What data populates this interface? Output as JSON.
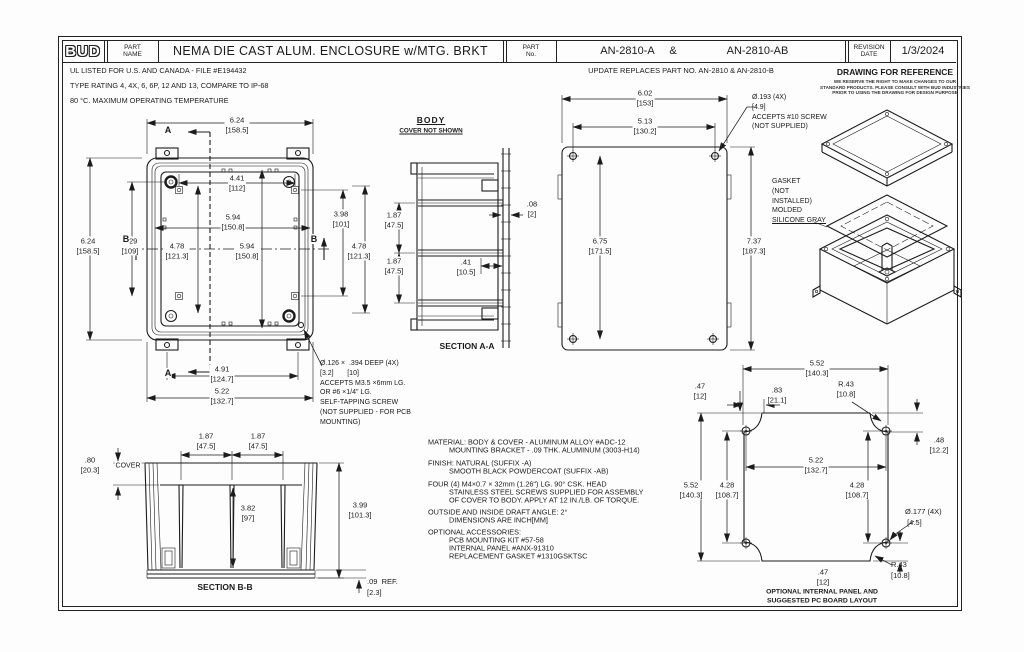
{
  "frame": {
    "logo": "BUD",
    "part_name_label": "PART\nNAME",
    "title": "NEMA DIE CAST ALUM. ENCLOSURE w/MTG. BRKT",
    "part_no_label": "PART\nNo.",
    "part_no_a": "AN-2810-A",
    "ampersand": "&",
    "part_no_b": "AN-2810-AB",
    "revision_label": "REVISION\nDATE",
    "revision_date": "1/3/2024"
  },
  "header_notes": {
    "ul": "UL LISTED FOR U.S. AND CANADA - FILE #E194432",
    "rating": "TYPE RATING 4, 4X, 6, 6P, 12 AND 13, COMPARE TO IP-68",
    "temp": "80 °C. MAXIMUM OPERATING TEMPERATURE",
    "update": "UPDATE REPLACES PART NO. AN-2810 & AN-2810-B",
    "ref_title": "DRAWING FOR REFERENCE",
    "ref_body": "WE RESERVE THE RIGHT TO MAKE CHANGES TO OUR\nSTANDARD PRODUCTS. PLEASE CONSULT WITH BUD INDUSTRIES\nPRIOR TO USING THE DRAWING FOR DESIGN PURPOSE"
  },
  "front_view": {
    "dim_width_top": "6.24\n[158.5]",
    "dim_height_left": "6.24\n[158.5]",
    "dim_429": "4.29\n[109]",
    "dim_441": "4.41\n[112]",
    "dim_594_top": "5.94\n[150.8]",
    "dim_478_left": "4.78\n[121.3]",
    "dim_594_right": "5.94\n[150.8]",
    "dim_398": "3.98\n[101]",
    "dim_478_right": "4.78\n[121.3]",
    "dim_491": "4.91\n[124.7]",
    "dim_522": "5.22\n[132.7]",
    "section_a": "A",
    "section_b": "B",
    "callout": "Ø.126 ×  .394 DEEP (4X)\n[3.2]       [10]\nACCEPTS M3.5 ×6mm LG.\nOR #6 ×1/4\" LG.\nSELF-TAPPING SCREW\n(NOT SUPPLIED - FOR PCB\nMOUNTING)"
  },
  "body_view": {
    "title": "BODY",
    "subtitle": "COVER NOT SHOWN",
    "dim_187a": "1.87\n[47.5]",
    "dim_187b": "1.87\n[47.5]",
    "dim_08": ".08\n[2]",
    "dim_41": ".41\n[10.5]",
    "label": "SECTION A-A"
  },
  "rear_view": {
    "dim_602": "6.02\n[153]",
    "dim_513": "5.13\n[130.2]",
    "dim_675": "6.75\n[171.5]",
    "dim_737": "7.37\n[187.3]",
    "callout_hole": "Ø.193 (4X)\n[4.9]\nACCEPTS #10 SCREW\n(NOT SUPPLIED)",
    "gasket_note": "GASKET\n(NOT\nINSTALLED)\nMOLDED",
    "gasket_note2": "SILICONE GRAY"
  },
  "section_bb": {
    "dim_187a": "1.87\n[47.5]",
    "dim_187b": "1.87\n[47.5]",
    "dim_080": ".80\n[20.3]",
    "cover_label": "COVER",
    "dim_382": "3.82\n[97]",
    "dim_399": "3.99\n[101.3]",
    "dim_009": ".09  REF.\n[2.3]",
    "label": "SECTION B-B"
  },
  "spec_notes": {
    "material": "MATERIAL: BODY & COVER - ALUMINUM ALLOY #ADC-12",
    "material2": "MOUNTING BRACKET - .09 THK. ALUMINUM (3003-H14)",
    "finish": "FINISH: NATURAL (SUFFIX -A)",
    "finish2": "SMOOTH BLACK POWDERCOAT (SUFFIX -AB)",
    "screws": "FOUR (4) M4×0.7 × 32mm (1.26\") LG. 90° CSK. HEAD",
    "screws2": "STAINLESS STEEL SCREWS SUPPLIED FOR ASSEMBLY",
    "screws3": "OF COVER TO BODY. APPLY AT 12 IN./LB. OF TORQUE.",
    "draft": "OUTSIDE AND INSIDE DRAFT ANGLE: 2°",
    "draft2": "DIMENSIONS ARE INCH[MM]",
    "accessories": "OPTIONAL ACCESSORIES:",
    "acc1": "PCB MOUNTING KIT #57-58",
    "acc2": "INTERNAL PANEL #ANX-91310",
    "acc3": "REPLACEMENT GASKET #1310GSKTSC"
  },
  "panel_view": {
    "dim_552_top": "5.52\n[140.3]",
    "dim_047_top": ".47\n[12]",
    "dim_083": ".83\n[21.1]",
    "dim_r43_top": "R.43\n[10.8]",
    "dim_048": ".48\n[12.2]",
    "dim_522": "5.22\n[132.7]",
    "dim_552_left": "5.52\n[140.3]",
    "dim_428_left": "4.28\n[108.7]",
    "dim_428_right": "4.28\n[108.7]",
    "dim_177": "Ø.177 (4X)\n [4.5]",
    "dim_r43_bottom": "R.43\n[10.8]",
    "dim_047_bottom": ".47\n[12]",
    "caption": "OPTIONAL INTERNAL PANEL AND\nSUGGESTED PC BOARD LAYOUT"
  }
}
